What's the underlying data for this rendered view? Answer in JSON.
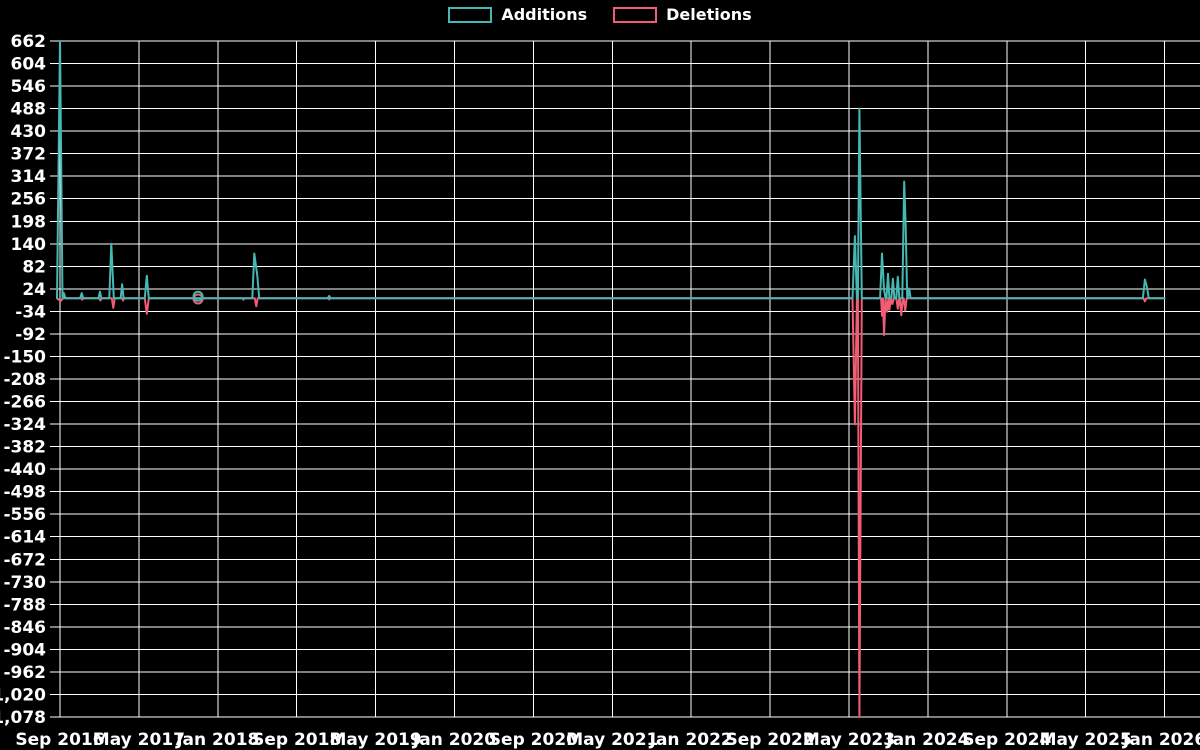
{
  "legend": {
    "additions_label": "Additions",
    "deletions_label": "Deletions"
  },
  "colors": {
    "additions": "#45b8b4",
    "deletions": "#f25d75",
    "grid": "#ffffff",
    "text": "#ffffff",
    "background": "#000000"
  },
  "chart_data": {
    "type": "line",
    "title": "",
    "legend_position": "top-center",
    "grid": true,
    "x_axis": {
      "tick_labels": [
        "Sep 2016",
        "May 2017",
        "Jan 2018",
        "Sep 2018",
        "May 2019",
        "Jan 2020",
        "Sep 2020",
        "May 2021",
        "Jan 2022",
        "Sep 2022",
        "May 2023",
        "Jan 2024",
        "Sep 2024",
        "May 2025",
        "Jan 2026"
      ],
      "months_per_tick": 8,
      "total_months": 112
    },
    "y_axis": {
      "max": 662,
      "min": -1078,
      "step": -58,
      "ticks": [
        662,
        604,
        546,
        488,
        430,
        372,
        314,
        256,
        198,
        140,
        82,
        24,
        -34,
        -92,
        -150,
        -208,
        -266,
        -324,
        -382,
        -440,
        -498,
        -556,
        -614,
        -672,
        -730,
        -788,
        -846,
        -904,
        -962,
        -1020,
        -1078
      ]
    },
    "series": [
      {
        "name": "Additions",
        "color": "#45b8b4",
        "points": [
          [
            -0.3,
            0
          ],
          [
            0,
            662
          ],
          [
            0.25,
            0
          ],
          [
            0.3,
            0
          ],
          [
            0.4,
            13
          ],
          [
            0.55,
            0
          ],
          [
            2.05,
            0
          ],
          [
            2.2,
            13
          ],
          [
            2.35,
            0
          ],
          [
            3.9,
            0
          ],
          [
            4.05,
            17
          ],
          [
            4.2,
            0
          ],
          [
            5.0,
            0
          ],
          [
            5.2,
            140
          ],
          [
            5.45,
            0
          ],
          [
            6.15,
            0
          ],
          [
            6.3,
            36
          ],
          [
            6.45,
            0
          ],
          [
            8.6,
            0
          ],
          [
            8.8,
            58
          ],
          [
            9.0,
            0
          ],
          [
            19.5,
            0
          ],
          [
            19.7,
            115
          ],
          [
            20.0,
            58
          ],
          [
            20.2,
            0
          ],
          [
            27.15,
            0
          ],
          [
            27.3,
            6
          ],
          [
            27.45,
            0
          ],
          [
            80.35,
            0
          ],
          [
            80.6,
            160
          ],
          [
            80.8,
            0
          ],
          [
            80.9,
            0
          ],
          [
            81.05,
            488
          ],
          [
            81.3,
            0
          ],
          [
            83.15,
            0
          ],
          [
            83.35,
            115
          ],
          [
            83.55,
            22
          ],
          [
            83.7,
            0
          ],
          [
            83.8,
            0
          ],
          [
            83.95,
            63
          ],
          [
            84.1,
            0
          ],
          [
            84.3,
            0
          ],
          [
            84.45,
            50
          ],
          [
            84.6,
            0
          ],
          [
            84.8,
            0
          ],
          [
            84.95,
            55
          ],
          [
            85.1,
            0
          ],
          [
            85.4,
            0
          ],
          [
            85.6,
            300
          ],
          [
            85.75,
            185
          ],
          [
            85.9,
            0
          ],
          [
            85.95,
            0
          ],
          [
            86.1,
            25
          ],
          [
            86.25,
            0
          ],
          [
            109.8,
            0
          ],
          [
            110.0,
            48
          ],
          [
            110.2,
            30
          ],
          [
            110.4,
            0
          ],
          [
            112,
            0
          ]
        ]
      },
      {
        "name": "Deletions",
        "color": "#f25d75",
        "points": [
          [
            -0.3,
            0
          ],
          [
            0.05,
            -8
          ],
          [
            0.3,
            0
          ],
          [
            2.15,
            0
          ],
          [
            2.25,
            -4
          ],
          [
            2.35,
            0
          ],
          [
            3.95,
            0
          ],
          [
            4.1,
            -6
          ],
          [
            4.25,
            0
          ],
          [
            5.25,
            0
          ],
          [
            5.4,
            -25
          ],
          [
            5.55,
            0
          ],
          [
            6.3,
            0
          ],
          [
            6.4,
            -6
          ],
          [
            6.5,
            0
          ],
          [
            8.6,
            0
          ],
          [
            8.8,
            -40
          ],
          [
            9.0,
            0
          ],
          [
            18.5,
            0
          ],
          [
            18.6,
            -4
          ],
          [
            18.7,
            0
          ],
          [
            19.75,
            0
          ],
          [
            19.9,
            -21
          ],
          [
            20.05,
            0
          ],
          [
            27.2,
            0
          ],
          [
            27.3,
            -3
          ],
          [
            27.4,
            0
          ],
          [
            80.35,
            0
          ],
          [
            80.6,
            -325
          ],
          [
            80.8,
            0
          ],
          [
            80.9,
            0
          ],
          [
            81.05,
            -1078
          ],
          [
            81.3,
            0
          ],
          [
            83.25,
            0
          ],
          [
            83.35,
            -45
          ],
          [
            83.45,
            0
          ],
          [
            83.55,
            -95
          ],
          [
            83.7,
            0
          ],
          [
            83.85,
            -35
          ],
          [
            84.0,
            0
          ],
          [
            84.1,
            -30
          ],
          [
            84.25,
            0
          ],
          [
            84.4,
            -15
          ],
          [
            84.55,
            0
          ],
          [
            84.8,
            0
          ],
          [
            84.95,
            -27
          ],
          [
            85.1,
            0
          ],
          [
            85.15,
            0
          ],
          [
            85.3,
            -44
          ],
          [
            85.45,
            0
          ],
          [
            85.55,
            0
          ],
          [
            85.7,
            -32
          ],
          [
            85.85,
            0
          ],
          [
            109.85,
            0
          ],
          [
            110.0,
            -8
          ],
          [
            110.15,
            0
          ],
          [
            112,
            0
          ]
        ]
      }
    ],
    "markers": [
      {
        "series": "Deletions",
        "month": 14.0,
        "value": -2,
        "shape": "open-circle",
        "color": "#f25d75"
      },
      {
        "series": "Additions",
        "month": 14.0,
        "value": 5,
        "shape": "open-circle",
        "color": "#45b8b4"
      }
    ]
  }
}
